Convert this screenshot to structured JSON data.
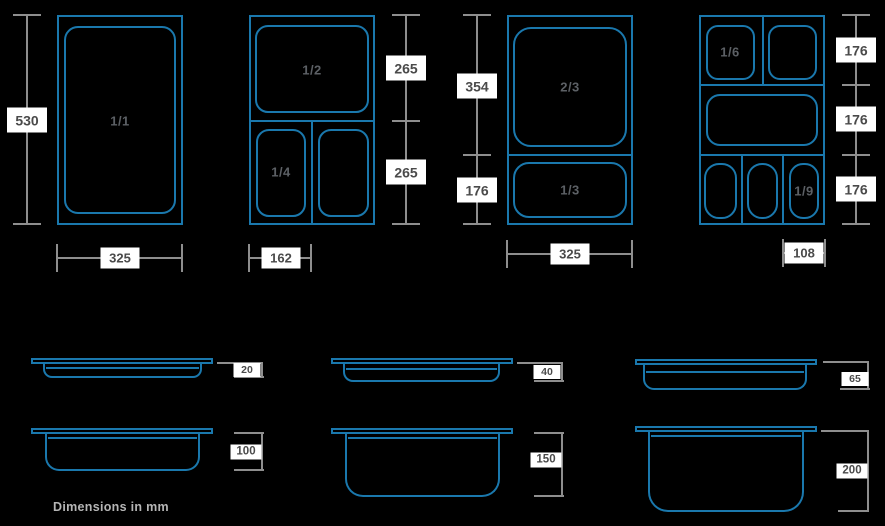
{
  "diagram_title": "Gastronorm pan sizes",
  "colors": {
    "background": "#000000",
    "pan_outline": "#1a78ad",
    "dimension_line": "#8e8e8e",
    "label_background": "#ffffff",
    "label_text": "#4a4a4a",
    "pan_label_text": "#5c6065",
    "footnote_text": "#b5b5b5"
  },
  "top_views": [
    {
      "id": "gn-1-1",
      "pan_labels": [
        "1/1"
      ],
      "height_dims": [
        "530"
      ],
      "width_dim": "325"
    },
    {
      "id": "gn-1-2-1-4",
      "pan_labels": [
        "1/2",
        "1/4"
      ],
      "height_dims": [
        "265",
        "265"
      ],
      "width_dim": "162"
    },
    {
      "id": "gn-2-3-1-3",
      "pan_labels": [
        "2/3",
        "1/3"
      ],
      "height_dims": [
        "354",
        "176"
      ],
      "width_dim": "325"
    },
    {
      "id": "gn-1-6-1-9",
      "pan_labels": [
        "1/6",
        "1/9"
      ],
      "height_dims": [
        "176",
        "176",
        "176"
      ],
      "width_dim": "108"
    }
  ],
  "side_views": [
    {
      "depth": "20"
    },
    {
      "depth": "40"
    },
    {
      "depth": "65"
    },
    {
      "depth": "100"
    },
    {
      "depth": "150"
    },
    {
      "depth": "200"
    }
  ],
  "footnote": "Dimensions in mm"
}
